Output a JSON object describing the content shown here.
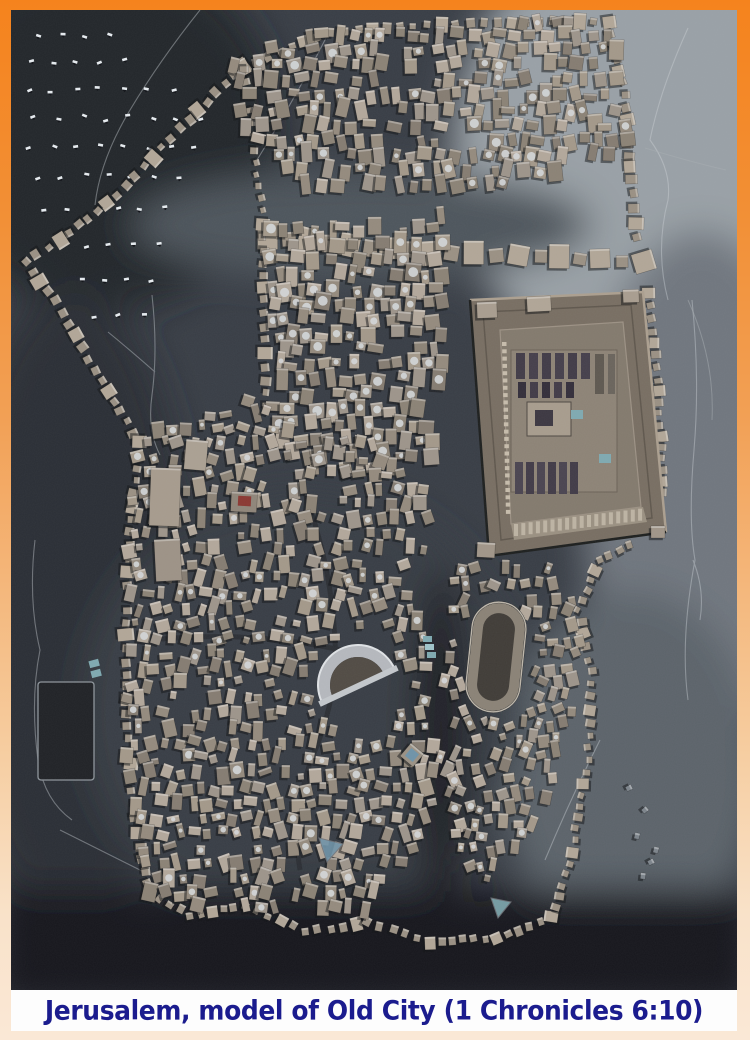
{
  "caption": {
    "text": "Jerusalem, model of Old City (1 Chronicles 6:10)",
    "color": "#1b1c8e",
    "background": "#fdfdfd"
  },
  "frame": {
    "gradient_top": "#f5831d",
    "gradient_middle": "#f2a055",
    "gradient_bottom": "#fae8d6"
  },
  "scene": {
    "label": "jerusalem-old-city-scale-model-photo",
    "features": [
      "tree-markers",
      "northwest-city-wall",
      "upper-city-district",
      "second-quarter-district",
      "temple-mount",
      "temple-complex",
      "lower-city-district",
      "city-of-david-district",
      "theater",
      "hippodrome",
      "pool",
      "terrain-cracks",
      "south-city-wall"
    ],
    "palette": {
      "terrainBase": "#383d45",
      "terrainLight": "#99a0a6",
      "terrainMid": "#6f767e",
      "terrainDark": "#23262c",
      "terrainBottom": "#15171a",
      "crack": "#ccd2d7",
      "buildings": [
        "#b2a79a",
        "#a39889",
        "#948a7d",
        "#8b8275",
        "#9d948a",
        "#857c71"
      ],
      "wallBlock": "#9a9083",
      "tower": "#b1a697",
      "shadow": "#101114",
      "dome": "#d3d6d8",
      "templePlatform": "#786e62",
      "templeCourt": "#837a6d",
      "templeDark": "#413b47",
      "templeLight": "#c6bcab",
      "theaterRing": "#b5b8bd",
      "theaterFloor": "#514b44",
      "accentRed": "#8a3832",
      "accentTeal": "#7fa9b0",
      "accentBlue": "#6f93a8",
      "treeMarker": "#e6ebef"
    }
  }
}
